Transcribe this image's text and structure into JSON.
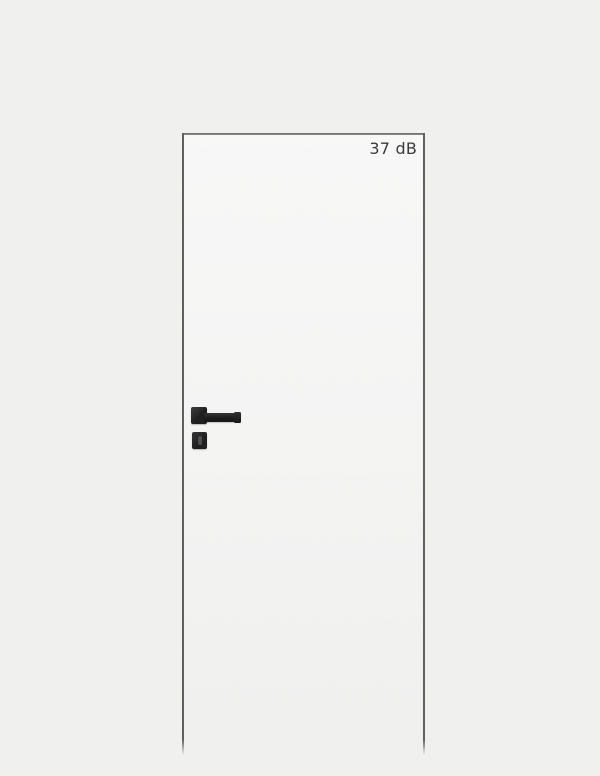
{
  "door": {
    "rating_label": "37 dB",
    "hardware": {
      "handle": "black-square-lever-handle",
      "lock": "keyhole-escutcheon"
    }
  },
  "colors": {
    "background": "#f1f1f0",
    "door_edge": "#5e5e5e",
    "handle": "#1d1d1d",
    "label_text": "#3a3a3a",
    "keyhole_slot": "#4d4d4d"
  }
}
